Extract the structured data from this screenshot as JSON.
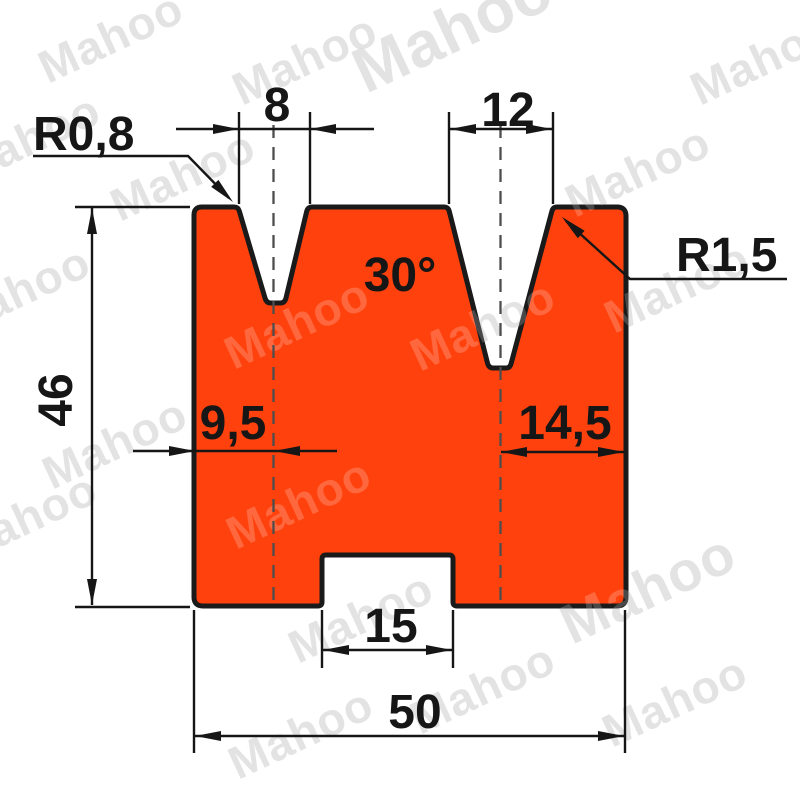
{
  "title": "2-V die technical drawing",
  "watermark": {
    "text": "Mahoo"
  },
  "labels": {
    "r_left": "R0,8",
    "v1_width": "8",
    "v2_width": "12",
    "angle": "30°",
    "r_right": "R1,5",
    "height": "46",
    "v1_offset": "9,5",
    "v2_offset": "14,5",
    "slot_width": "15",
    "total_width": "50"
  },
  "dimensions": [
    {
      "name": "left V opening width",
      "value": "8"
    },
    {
      "name": "right V opening width",
      "value": "12"
    },
    {
      "name": "V angle",
      "value": "30°"
    },
    {
      "name": "left V tip radius",
      "value": "R0,8"
    },
    {
      "name": "right V shoulder radius",
      "value": "R1,5"
    },
    {
      "name": "die height",
      "value": "46"
    },
    {
      "name": "left V center from left edge",
      "value": "9,5"
    },
    {
      "name": "right V center from right edge",
      "value": "14,5"
    },
    {
      "name": "bottom slot width",
      "value": "15"
    },
    {
      "name": "total width",
      "value": "50"
    }
  ],
  "colors": {
    "fill": "#ff420d",
    "outline": "#1a1a1a",
    "ink": "#161616",
    "centerline": "#4d4d4d",
    "wm_gray": "#c2c2c2"
  }
}
